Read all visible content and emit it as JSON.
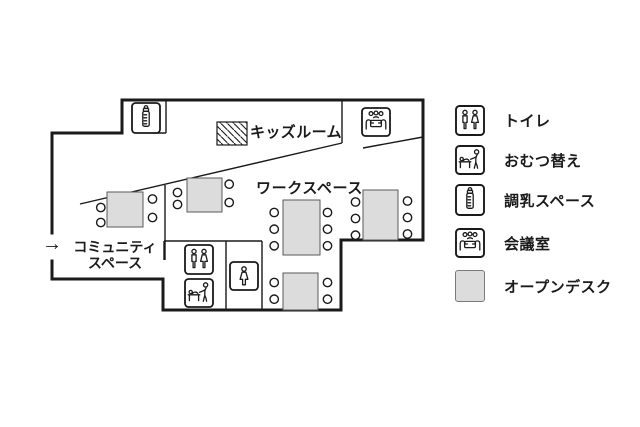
{
  "plan": {
    "entrance_arrow": "→",
    "rooms": {
      "kids_room": "キッズルーム",
      "workspace": "ワークスペース",
      "community_line1": "コミュニティ",
      "community_line2": "スペース"
    }
  },
  "legend": {
    "items": [
      {
        "icon": "toilet-icon",
        "label": "トイレ"
      },
      {
        "icon": "diaper-change-icon",
        "label": "おむつ替え"
      },
      {
        "icon": "baby-bottle-icon",
        "label": "調乳スペース"
      },
      {
        "icon": "meeting-room-icon",
        "label": "会議室"
      },
      {
        "icon": "open-desk-swatch",
        "label": "オープンデスク"
      }
    ]
  },
  "colors": {
    "line": "#1a1a1a",
    "desk_fill": "#dcdcdc",
    "background": "#ffffff"
  }
}
